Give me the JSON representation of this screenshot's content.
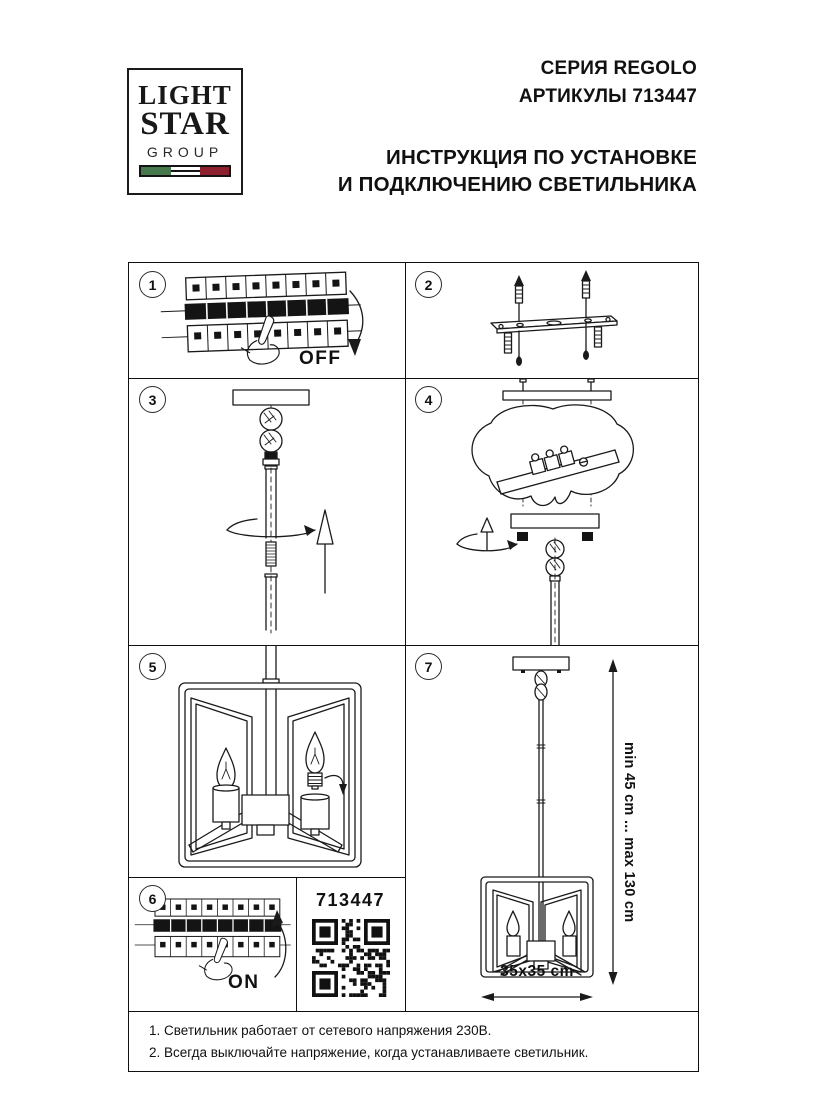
{
  "logo": {
    "line1": "LIGHT",
    "line2": "STAR",
    "line3": "GROUP"
  },
  "header": {
    "series": "СЕРИЯ REGOLO",
    "articles": "АРТИКУЛЫ 713447",
    "title_line1": "ИНСТРУКЦИЯ ПО УСТАНОВКЕ",
    "title_line2": "И ПОДКЛЮЧЕНИЮ СВЕТИЛЬНИКА"
  },
  "steps": {
    "1": {
      "num": "1",
      "label": "OFF"
    },
    "2": {
      "num": "2"
    },
    "3": {
      "num": "3"
    },
    "4": {
      "num": "4"
    },
    "5": {
      "num": "5"
    },
    "6": {
      "num": "6",
      "label": "ON"
    },
    "7": {
      "num": "7",
      "dim_vertical": "min 45 cm ... max 130 cm",
      "dim_horizontal": "35x35 cm"
    }
  },
  "qr_panel": {
    "article": "713447"
  },
  "notes": [
    "1. Светильник работает от сетевого напряжения 230В.",
    "2. Всегда выключайте напряжение, когда устанавливаете светильник."
  ],
  "colors": {
    "flag_green": "#45794b",
    "flag_red": "#8e1f2f",
    "line": "#1a1a1a"
  }
}
